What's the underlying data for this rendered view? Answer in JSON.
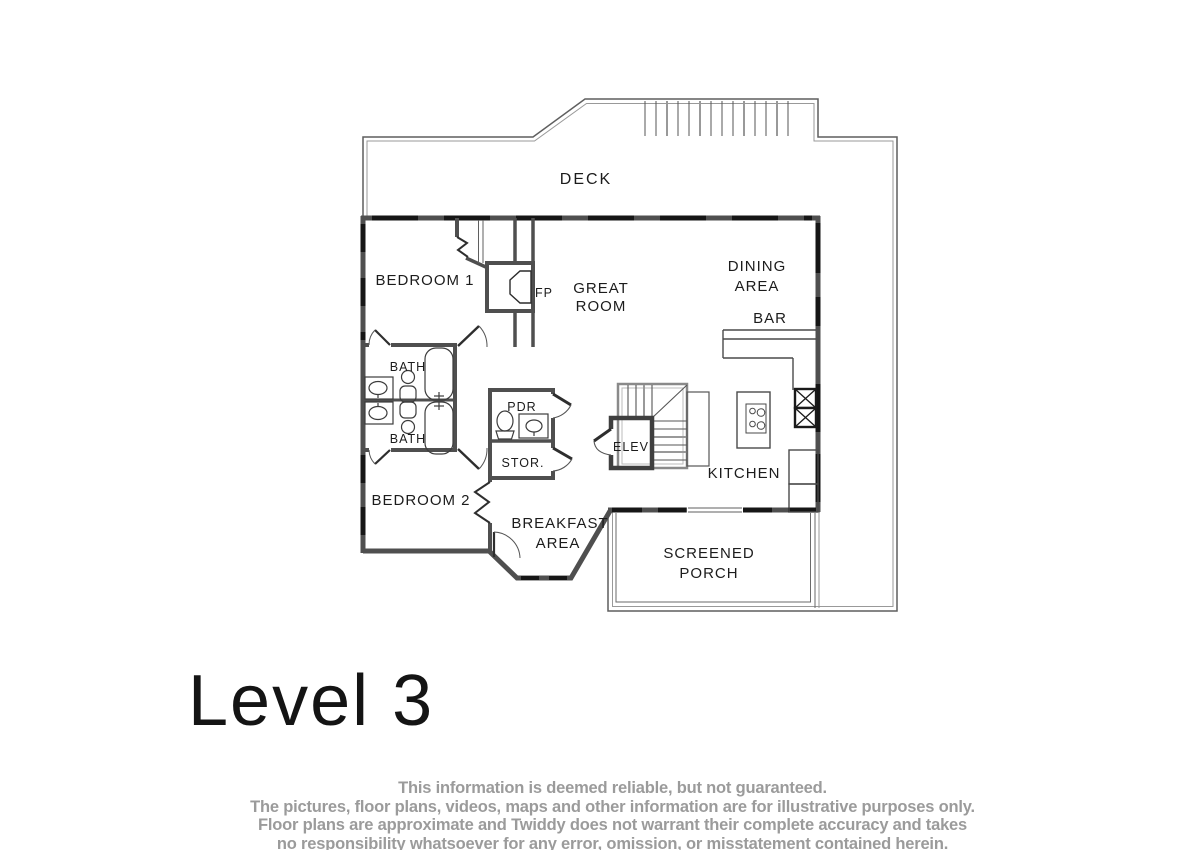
{
  "title": {
    "level_label": "Level 3"
  },
  "plan": {
    "rooms": {
      "deck": "DECK",
      "bedroom1": "BEDROOM 1",
      "fireplace": "FP",
      "great_room": [
        "GREAT",
        "ROOM"
      ],
      "dining_area": [
        "DINING",
        "AREA"
      ],
      "bar": "BAR",
      "bath_top": "BATH",
      "bath_bottom": "BATH",
      "powder": "PDR",
      "storage": "STOR.",
      "elevator": "ELEV",
      "kitchen": "KITCHEN",
      "bedroom2": "BEDROOM 2",
      "breakfast_area": [
        "BREAKFAST",
        "AREA"
      ],
      "screened_porch": [
        "SCREENED",
        "PORCH"
      ]
    },
    "colors": {
      "wall": "#4f4f4f",
      "window": "#161616",
      "thin_line": "#5f5f5f",
      "light_line": "#999999",
      "label_text": "#1c1c1c"
    }
  },
  "disclaimer": {
    "lines": [
      "This information is deemed reliable, but not guaranteed.",
      "The pictures, floor plans, videos, maps and other information are for illustrative purposes only.",
      "Floor plans are approximate and Twiddy does not warrant their complete accuracy and takes",
      "no responsibility whatsoever for any error, omission, or misstatement contained herein."
    ]
  }
}
